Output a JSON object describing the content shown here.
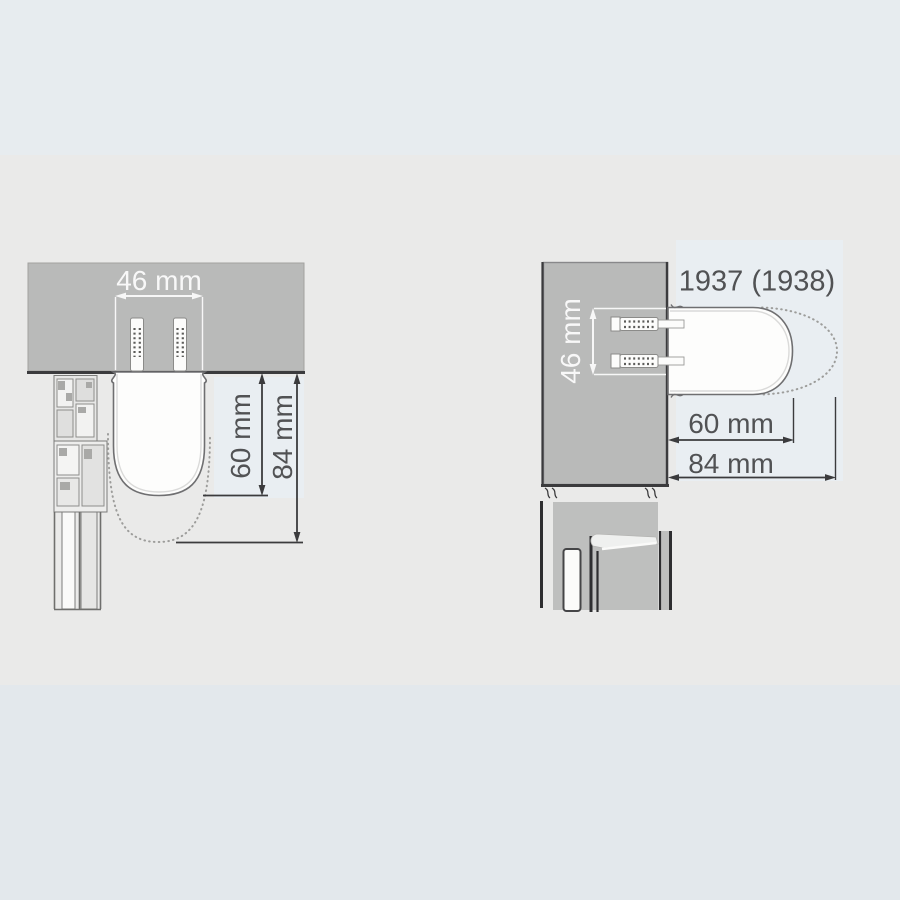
{
  "diagram": {
    "model_label": "1937 (1938)",
    "front_view": {
      "width_label": "46 mm",
      "depth_60_label": "60 mm",
      "depth_84_label": "84 mm"
    },
    "plan_view": {
      "spacing_label": "46 mm",
      "projection_60_label": "60 mm",
      "projection_84_label": "84 mm"
    }
  },
  "colors": {
    "band_top": "#e7ecef",
    "band_middle": "#eaeae9",
    "band_bottom": "#e3e8ec",
    "wall_gray": "#b9bab9",
    "panel_light": "#e9eef2",
    "line_dark": "#3b3b3d",
    "outline_gray": "#6f6f71",
    "text_dark": "#515254",
    "text_light": "#f8f8f8",
    "handle_white": "#fdfdfc"
  }
}
